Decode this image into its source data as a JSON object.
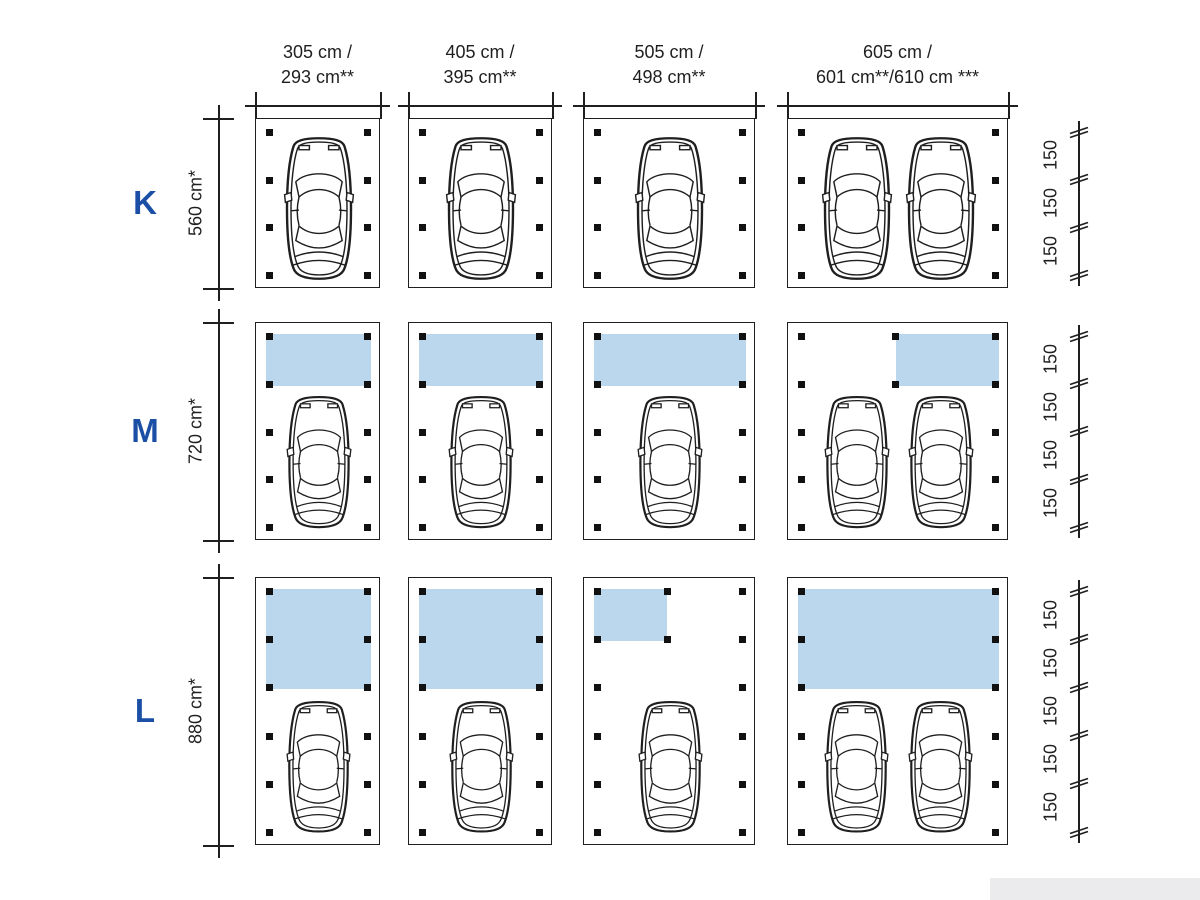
{
  "diagram_title": "Carport size matrix: widths vs depths with canopy storage options",
  "colors": {
    "accent_blue": "#1b4fa6",
    "canopy_blue": "#bad7ee",
    "line": "#1f1f1f"
  },
  "columns": [
    {
      "width_label_line1": "305 cm /",
      "width_label_line2": "293 cm**"
    },
    {
      "width_label_line1": "405 cm /",
      "width_label_line2": "395 cm**"
    },
    {
      "width_label_line1": "505 cm /",
      "width_label_line2": "498 cm**"
    },
    {
      "width_label_line1": "605 cm /",
      "width_label_line2": "601 cm**/610 cm ***"
    }
  ],
  "rows": [
    {
      "size_label": "K",
      "depth_label": "560 cm*",
      "segment_count": 3,
      "segment_label": "150"
    },
    {
      "size_label": "M",
      "depth_label": "720 cm*",
      "segment_count": 4,
      "segment_label": "150"
    },
    {
      "size_label": "L",
      "depth_label": "880 cm*",
      "segment_count": 5,
      "segment_label": "150"
    }
  ],
  "cells": [
    {
      "row": 0,
      "col": 0,
      "cars": 1,
      "canopy": null
    },
    {
      "row": 0,
      "col": 1,
      "cars": 1,
      "canopy": null
    },
    {
      "row": 0,
      "col": 2,
      "cars": 1,
      "canopy": null
    },
    {
      "row": 0,
      "col": 3,
      "cars": 2,
      "canopy": null
    },
    {
      "row": 1,
      "col": 0,
      "cars": 1,
      "canopy": {
        "depth_segments": 1,
        "span": "full"
      }
    },
    {
      "row": 1,
      "col": 1,
      "cars": 1,
      "canopy": {
        "depth_segments": 1,
        "span": "full"
      }
    },
    {
      "row": 1,
      "col": 2,
      "cars": 1,
      "canopy": {
        "depth_segments": 1,
        "span": "full"
      }
    },
    {
      "row": 1,
      "col": 3,
      "cars": 2,
      "canopy": {
        "depth_segments": 1,
        "span": "right-half"
      }
    },
    {
      "row": 2,
      "col": 0,
      "cars": 1,
      "canopy": {
        "depth_segments": 2,
        "span": "full"
      }
    },
    {
      "row": 2,
      "col": 1,
      "cars": 1,
      "canopy": {
        "depth_segments": 2,
        "span": "full"
      }
    },
    {
      "row": 2,
      "col": 2,
      "cars": 1,
      "canopy": {
        "depth_segments": 1,
        "span": "left-partial"
      }
    },
    {
      "row": 2,
      "col": 3,
      "cars": 2,
      "canopy": {
        "depth_segments": 2,
        "span": "full"
      }
    }
  ]
}
